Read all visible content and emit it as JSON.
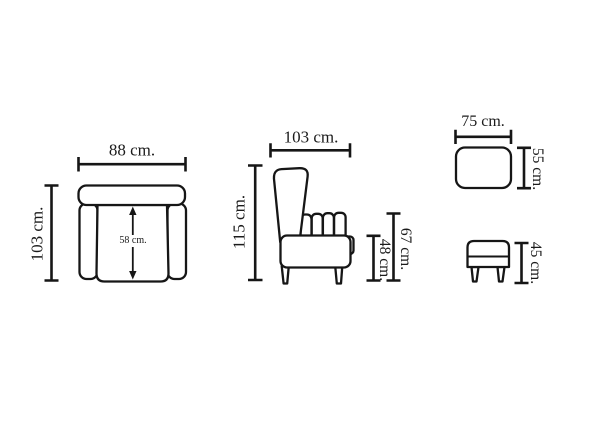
{
  "labels": {
    "armchair_top": {
      "width": "88 cm.",
      "depth": "103 cm.",
      "seat_width": "58 cm."
    },
    "armchair_side": {
      "depth": "103 cm.",
      "height": "115 cm.",
      "arm_height": "67 cm.",
      "seat_height": "48 cm."
    },
    "ottoman_top": {
      "width": "75 cm.",
      "depth": "55 cm."
    },
    "ottoman_side": {
      "height": "45 cm."
    }
  },
  "colors": {
    "line": "#161616",
    "background": "#ffffff",
    "text": "#1b1b1b"
  }
}
